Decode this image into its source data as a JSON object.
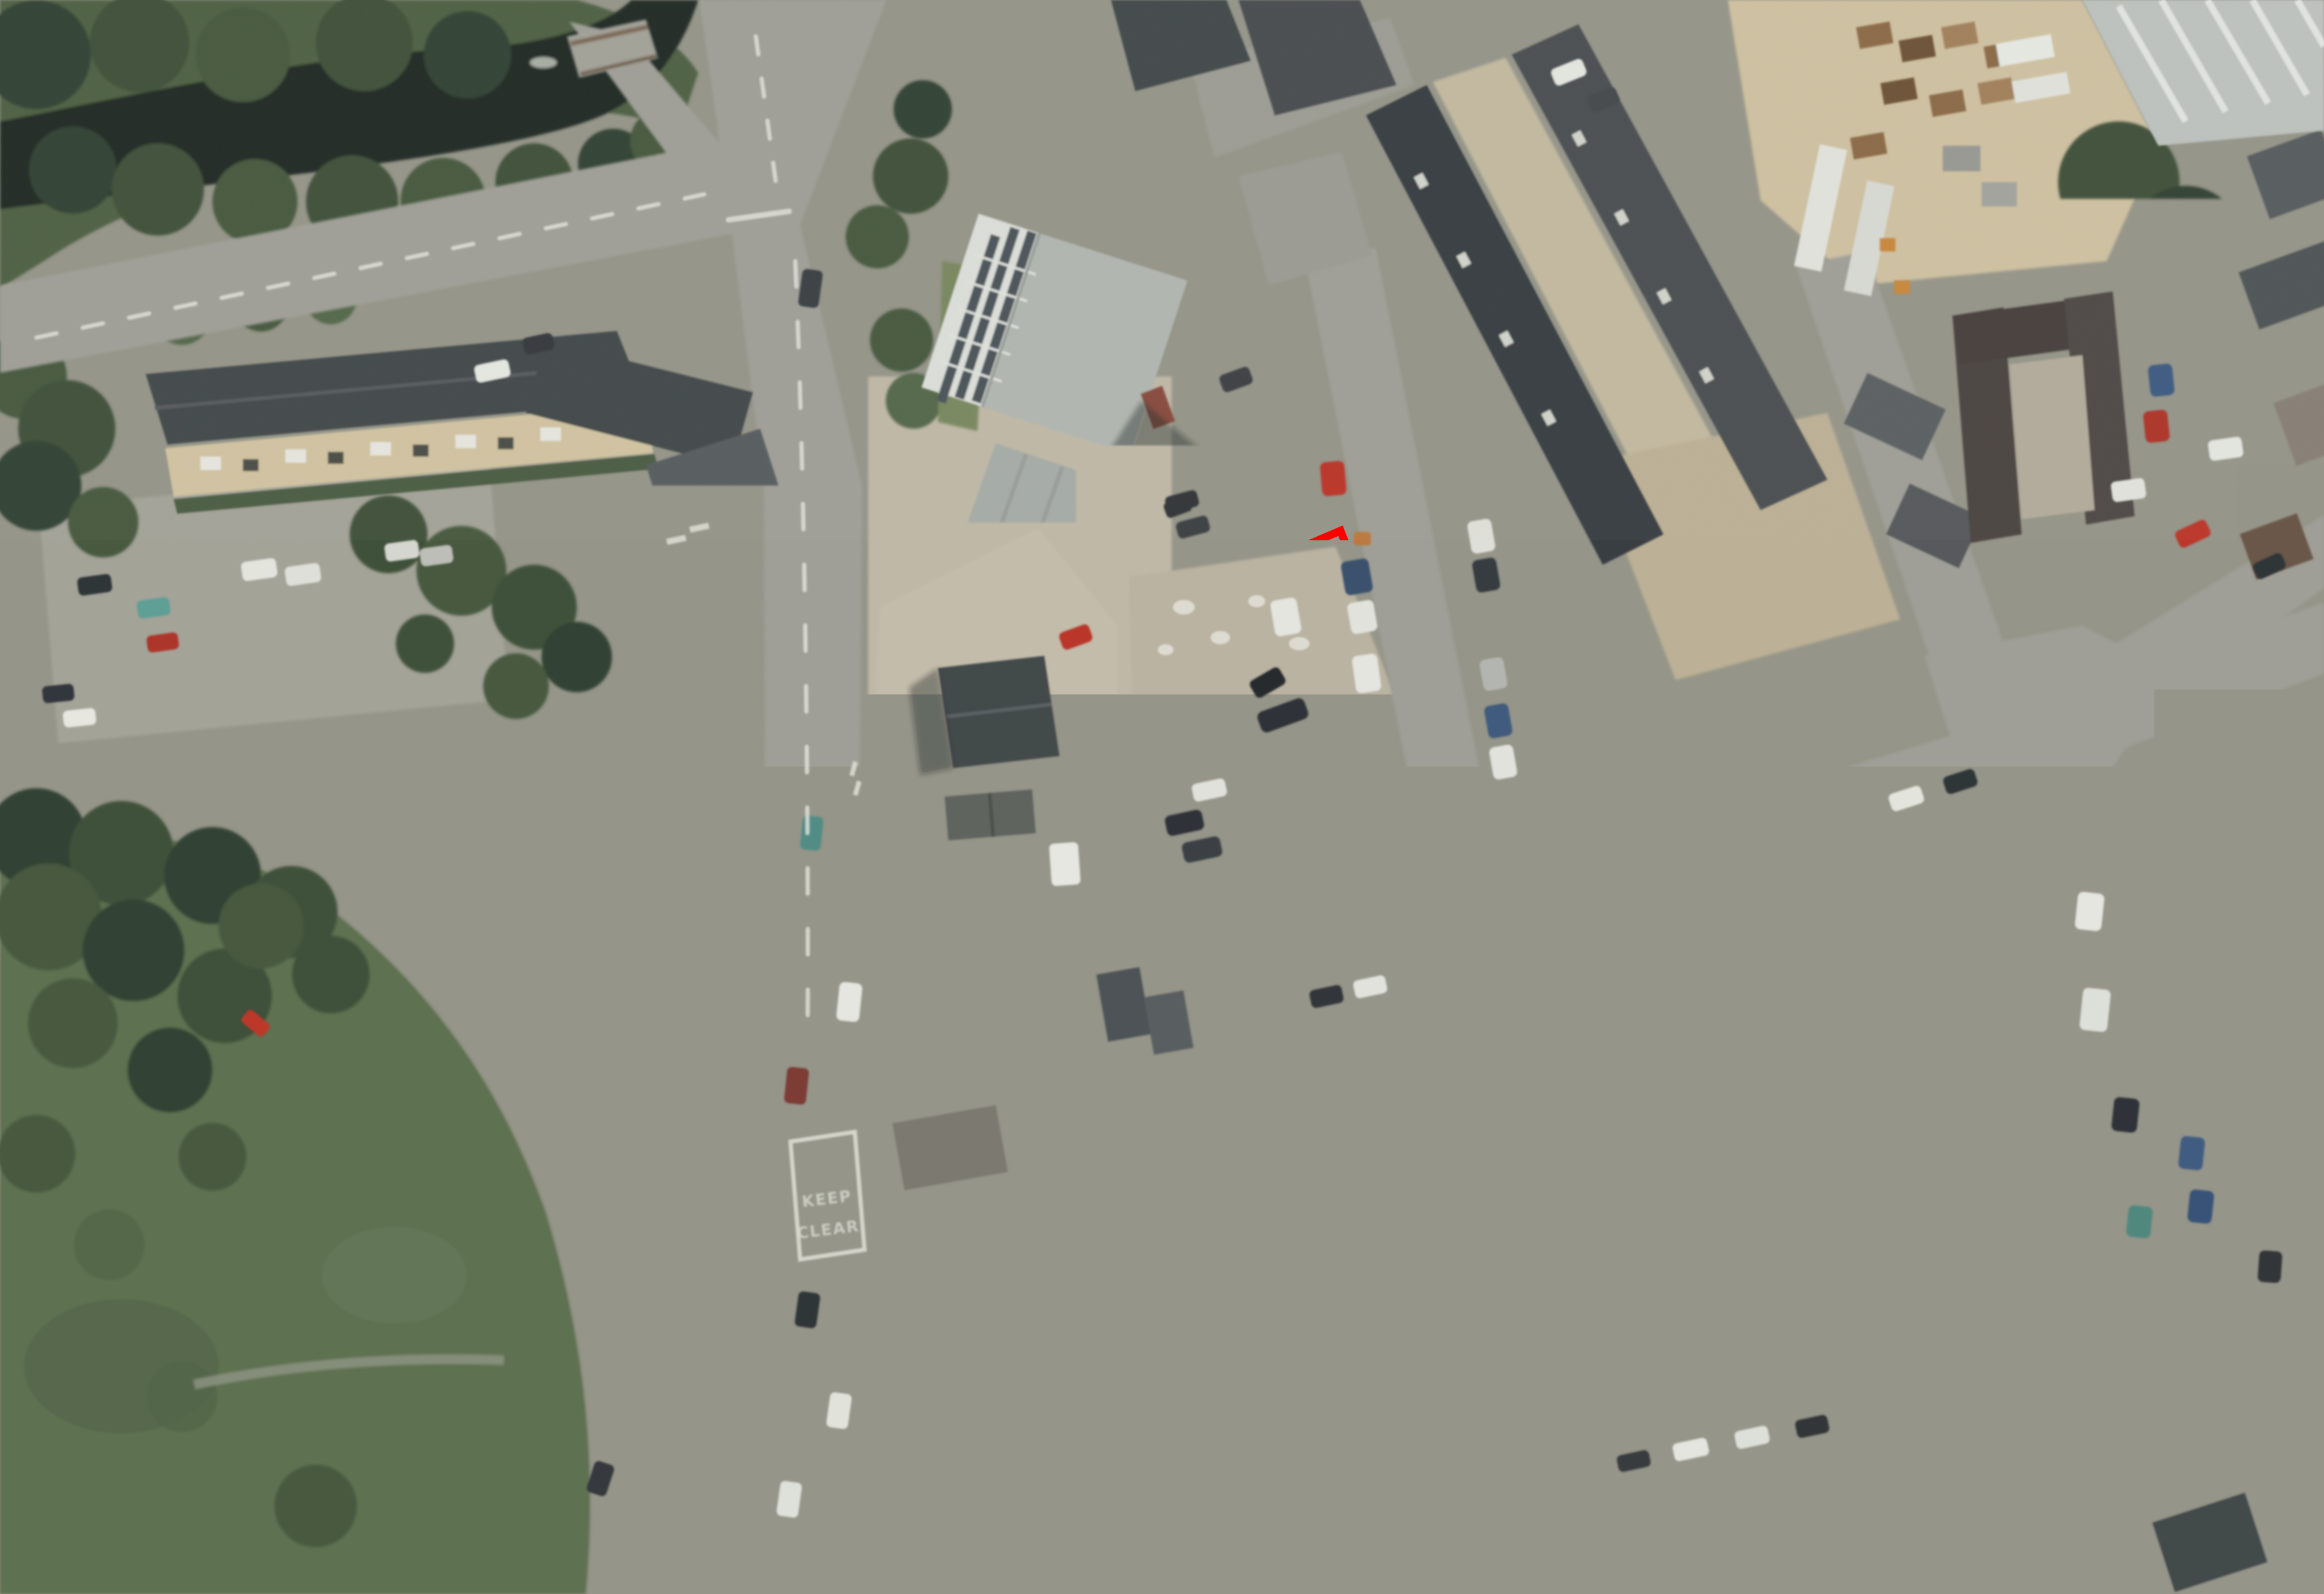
{
  "overlay": {
    "copyright": "© Crown Copyright and database rights 2026 OS AC0000829429",
    "boundary_color": "#ff0000",
    "site_boundary_points": "2208,874 2290,1085 2419,1442 2217,1459 2050,1485 1830,1519 1563,1545 1387,1562 1370,1313 1670,1277 1856,1250 1838,1234 1829,1072 1856,1060 1844,1030",
    "inner_plot_points": "1549,1312 1689,1300 1694,1356 1554,1368",
    "scale_bar": {
      "labels": [
        "0",
        "25 m",
        "50 m"
      ],
      "total_length_m": 50,
      "segments": 4
    },
    "north_arrow_icon": "compass-crosshair-north",
    "road_markings": {
      "keep": "KEEP",
      "clear": "CLEAR"
    }
  }
}
